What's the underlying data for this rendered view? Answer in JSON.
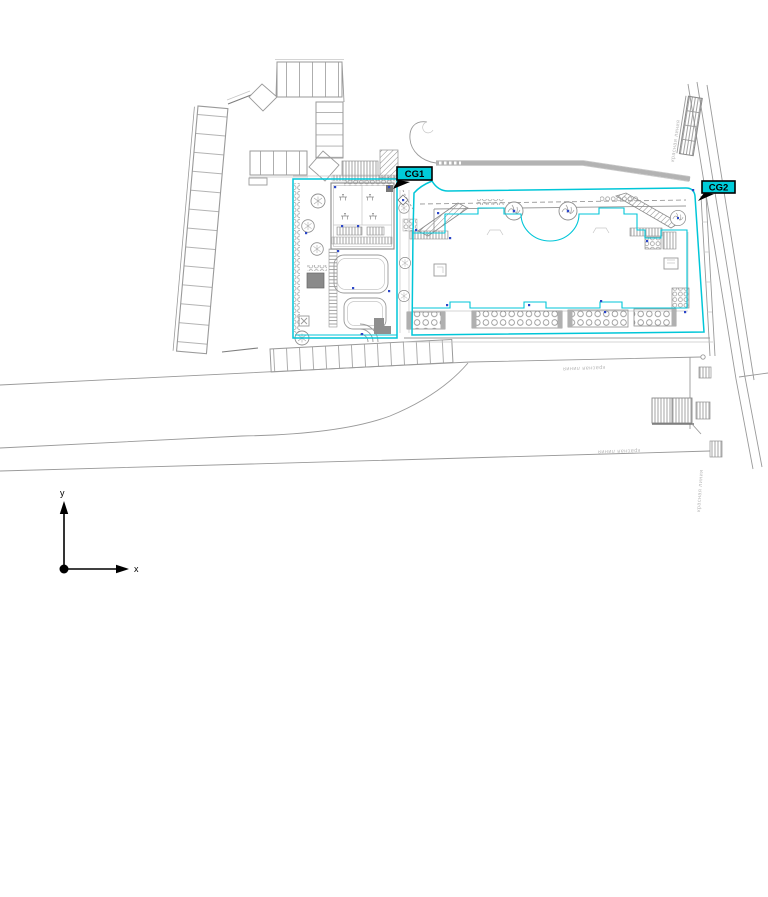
{
  "plan": {
    "type": "cad-site-plan",
    "tags": {
      "cg1": "CG1",
      "cg2": "CG2"
    },
    "red_line": {
      "label": "красная линия"
    },
    "axis": {
      "x": "x",
      "y": "y"
    }
  },
  "colors": {
    "accent_cyan": "#00c6d8",
    "tag_fill": "#00ccd9",
    "line_gray": "#9a9a9a",
    "light_gray": "#c6c6c6",
    "muted_label": "#b9b9b9",
    "marker_blue": "#2b46c8",
    "black": "#000000",
    "background": "#ffffff"
  }
}
